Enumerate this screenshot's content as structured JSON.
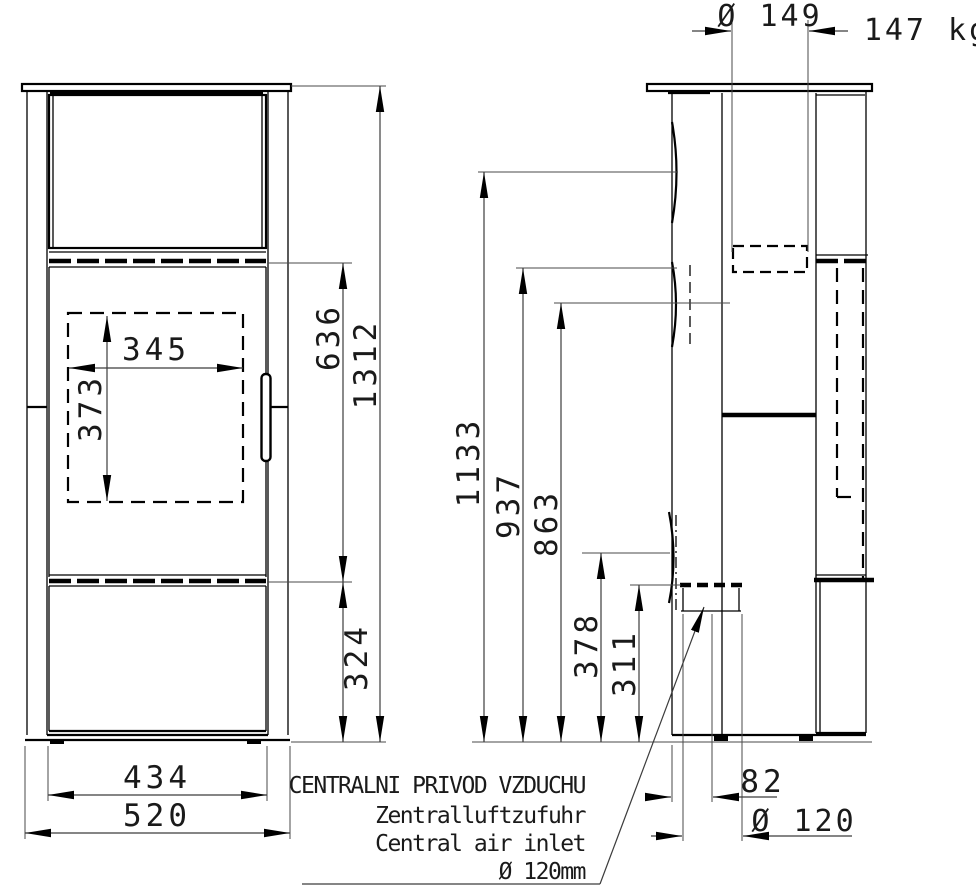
{
  "weight": "147 kg",
  "front_view": {
    "glass_width": "345",
    "glass_height": "373",
    "firebox_top_height": "636",
    "total_height": "1312",
    "base_height": "324",
    "inner_width": "434",
    "total_width": "520"
  },
  "side_view": {
    "flue_diameter": "Ø 149",
    "top_outlet_height": "1133",
    "rear_flue_top_height": "937",
    "rear_flue_center_height": "863",
    "inlet_top_height": "378",
    "inlet_center_height": "311",
    "inlet_back_offset": "82",
    "inlet_diameter": "Ø 120"
  },
  "air_inlet_note": {
    "line1": "CENTRALNI PRIVOD VZDUCHU",
    "line2": "Zentralluftzufuhr",
    "line3": "Central air inlet",
    "line4": "Ø 120mm"
  }
}
